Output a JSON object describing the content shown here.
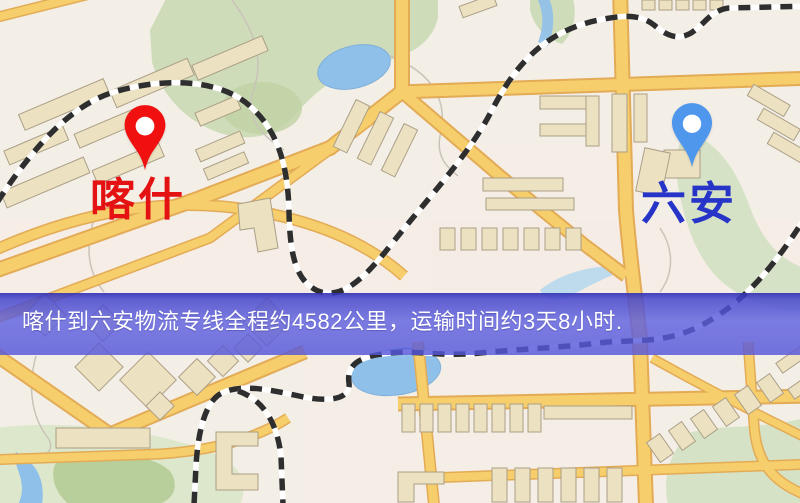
{
  "route_banner": {
    "text": "喀什到六安物流专线全程约4582公里，运输时间约3天8小时.",
    "origin": "喀什",
    "destination": "六安",
    "distance": "约4582公里",
    "duration": "约3天8小时",
    "background_color": "#5658dc",
    "text_color": "#ffffff"
  },
  "markers": {
    "origin": {
      "label": "喀什",
      "pin_color": "#f11010",
      "label_color": "#e41212"
    },
    "destination": {
      "label": "六安",
      "pin_color": "#4f96ed",
      "label_color": "#2635c8"
    }
  },
  "map_palette": {
    "background": "#f3efe7",
    "road_fill": "#f6ce6c",
    "road_casing": "#e3ab56",
    "park_green": "#cfdcba",
    "water_blue": "#8fc0ea",
    "building_fill": "#ece2c2",
    "railway_dark": "#2e2e2e"
  }
}
